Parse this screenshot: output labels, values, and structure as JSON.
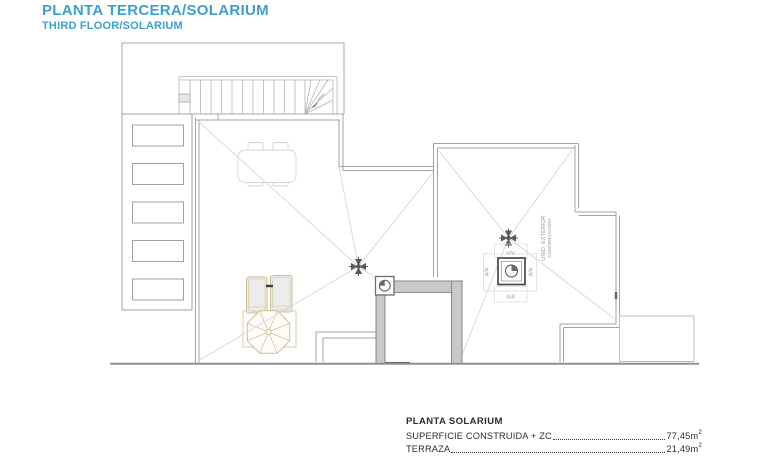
{
  "header": {
    "title": "PLANTA TERCERA/SOLARIUM",
    "subtitle": "THIRD FLOOR/SOLARIUM"
  },
  "plan": {
    "condenser_label_line1": "UNID. EXTERIOR",
    "condenser_label_line2": "CONDENSADORA",
    "valve_label": "V/V",
    "ac_label_left": "A/A",
    "ac_label_right": "A/A",
    "ac_label_bottom": "A/A"
  },
  "summary": {
    "heading": "PLANTA SOLARIUM",
    "rows": [
      {
        "label": "SUPERFICIE CONSTRUIDA + ZC",
        "value": "77,45m",
        "sup": "2"
      },
      {
        "label": "TERRAZA",
        "value": "21,49m",
        "sup": "2"
      }
    ]
  },
  "colors": {
    "title_blue": "#3E9ECC",
    "wall_gray": "#c9c9c9",
    "line_gray": "#a8a8a8",
    "furniture_tan": "#cdbf97"
  }
}
